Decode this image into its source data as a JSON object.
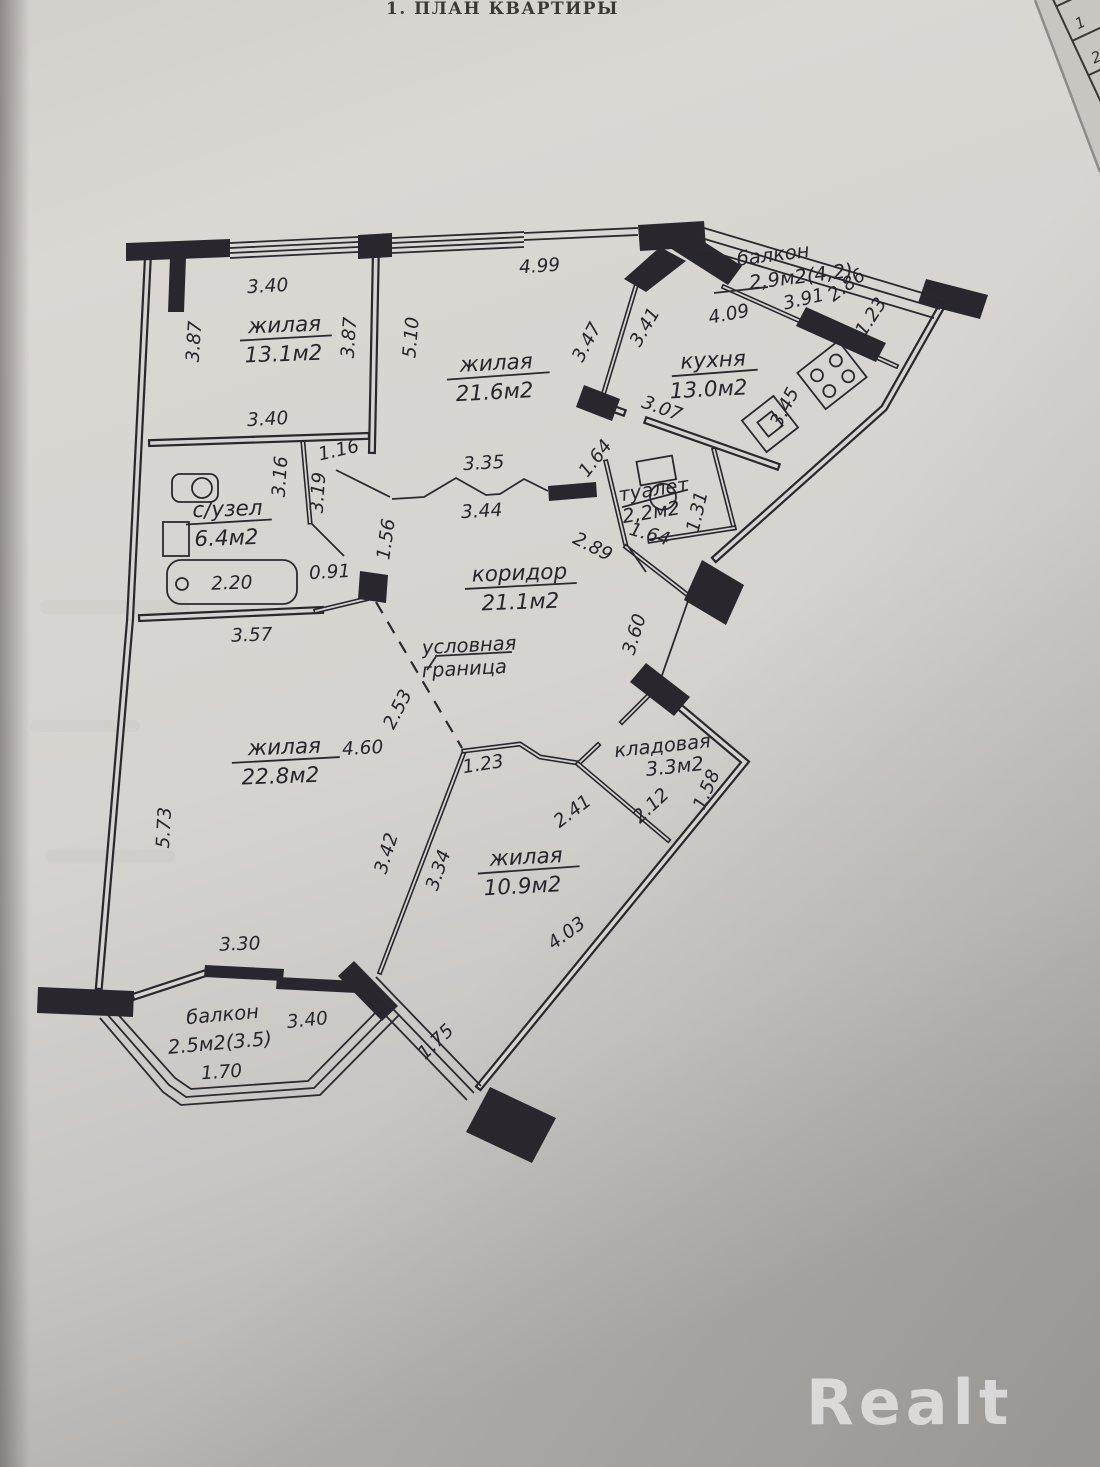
{
  "page": {
    "title": "1. ПЛАН КВАРТИРЫ",
    "watermark": "Realt",
    "corner_table": {
      "rows": [
        "1",
        "2",
        "3",
        "4"
      ]
    }
  },
  "plan": {
    "boundary_label": {
      "line1": "условная",
      "line2": "граница"
    },
    "rooms": {
      "living1": {
        "name": "жилая",
        "area": "13.1м2"
      },
      "living2": {
        "name": "жилая",
        "area": "21.6м2"
      },
      "kitchen": {
        "name": "кухня",
        "area": "13.0м2"
      },
      "balcony_top": {
        "name": "балкон",
        "area": "2,9м2(4,2)"
      },
      "bathroom": {
        "name": "с/узел",
        "area": "6.4м2"
      },
      "toilet": {
        "name": "туалет",
        "area": "2,2м2"
      },
      "corridor": {
        "name": "коридор",
        "area": "21.1м2"
      },
      "living3": {
        "name": "жилая",
        "area": "22.8м2"
      },
      "storage": {
        "name": "кладовая",
        "area": "3.3м2"
      },
      "living4": {
        "name": "жилая",
        "area": "10.9м2"
      },
      "balcony_bottom": {
        "name": "балкон",
        "area": "2.5м2(3.5)"
      }
    },
    "dims": {
      "d340a": "3.40",
      "d387l": "3.87",
      "d387r": "3.87",
      "d510": "5.10",
      "d340b": "3.40",
      "d499": "4.99",
      "d347": "3.47",
      "d341": "3.41",
      "d286": "2.86",
      "d391": "3.91",
      "d123a": "1.23",
      "d409": "4.09",
      "d345": "3.45",
      "d307": "3.07",
      "d164a": "1.64",
      "d131": "1.31",
      "d164b": "1.64",
      "d289": "2.89",
      "d316": "3.16",
      "d116": "1.16",
      "d319": "3.19",
      "d220": "2.20",
      "d091": "0.91",
      "d156": "1.56",
      "d335": "3.35",
      "d344": "3.44",
      "d357": "3.57",
      "d253": "2.53",
      "d360": "3.60",
      "d460": "4.60",
      "d573": "5.73",
      "d123b": "1.23",
      "d241": "2.41",
      "d212": "2.12",
      "d158": "1.58",
      "d342": "3.42",
      "d334": "3.34",
      "d403": "4.03",
      "d330": "3.30",
      "d340c": "3.40",
      "d170": "1.70",
      "d175": "1.75"
    }
  }
}
